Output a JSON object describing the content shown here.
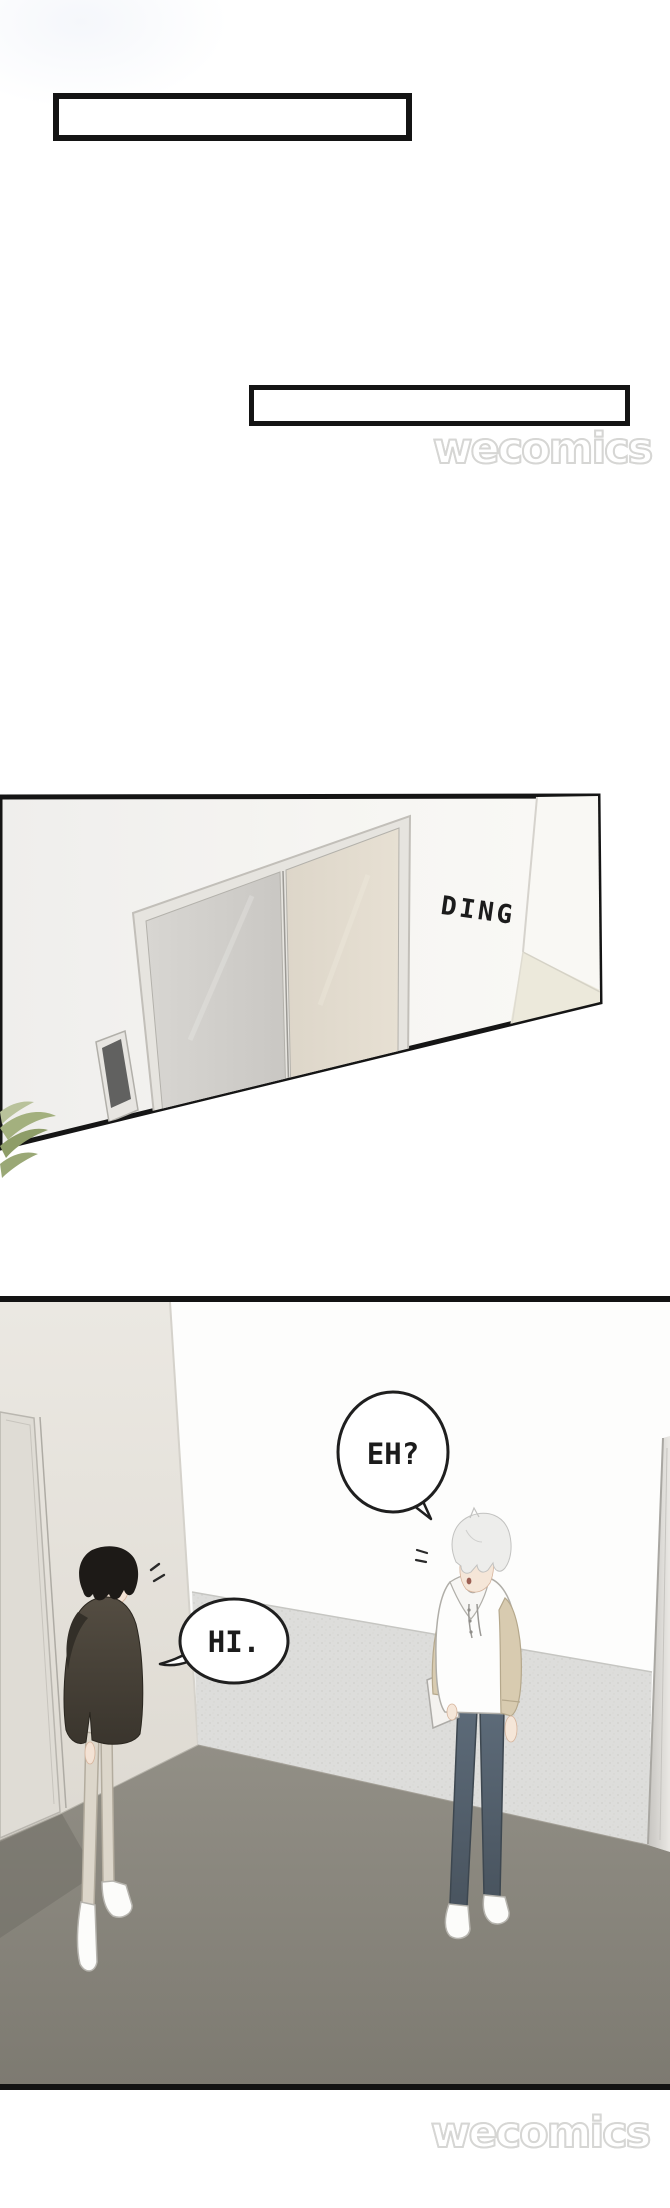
{
  "comic": {
    "caption_box_1": "",
    "caption_box_2": "",
    "panel_elevator": {
      "sfx_ding": "DING"
    },
    "panel_hallway": {
      "bubble_eh": "EH?",
      "bubble_hi": "HI."
    },
    "watermark_top": "wecomics",
    "watermark_bottom": "wecomics"
  },
  "colors": {
    "panel_border": "#151515",
    "wall_white": "#f6f5f2",
    "wall_warm": "#e8e5de",
    "wainscot": "#dddddb",
    "floor": "#8a877d",
    "elevator_door_left": "#d5d3cf",
    "elevator_door_right": "#e0d9cc",
    "call_button_screen": "#616160",
    "hoodie_dark": "#46413a",
    "sleeve_tan": "#d8cbb0",
    "jeans": "#55626f",
    "plant_green": "#9aa876",
    "watermark_outline": "#d6d6d4"
  }
}
